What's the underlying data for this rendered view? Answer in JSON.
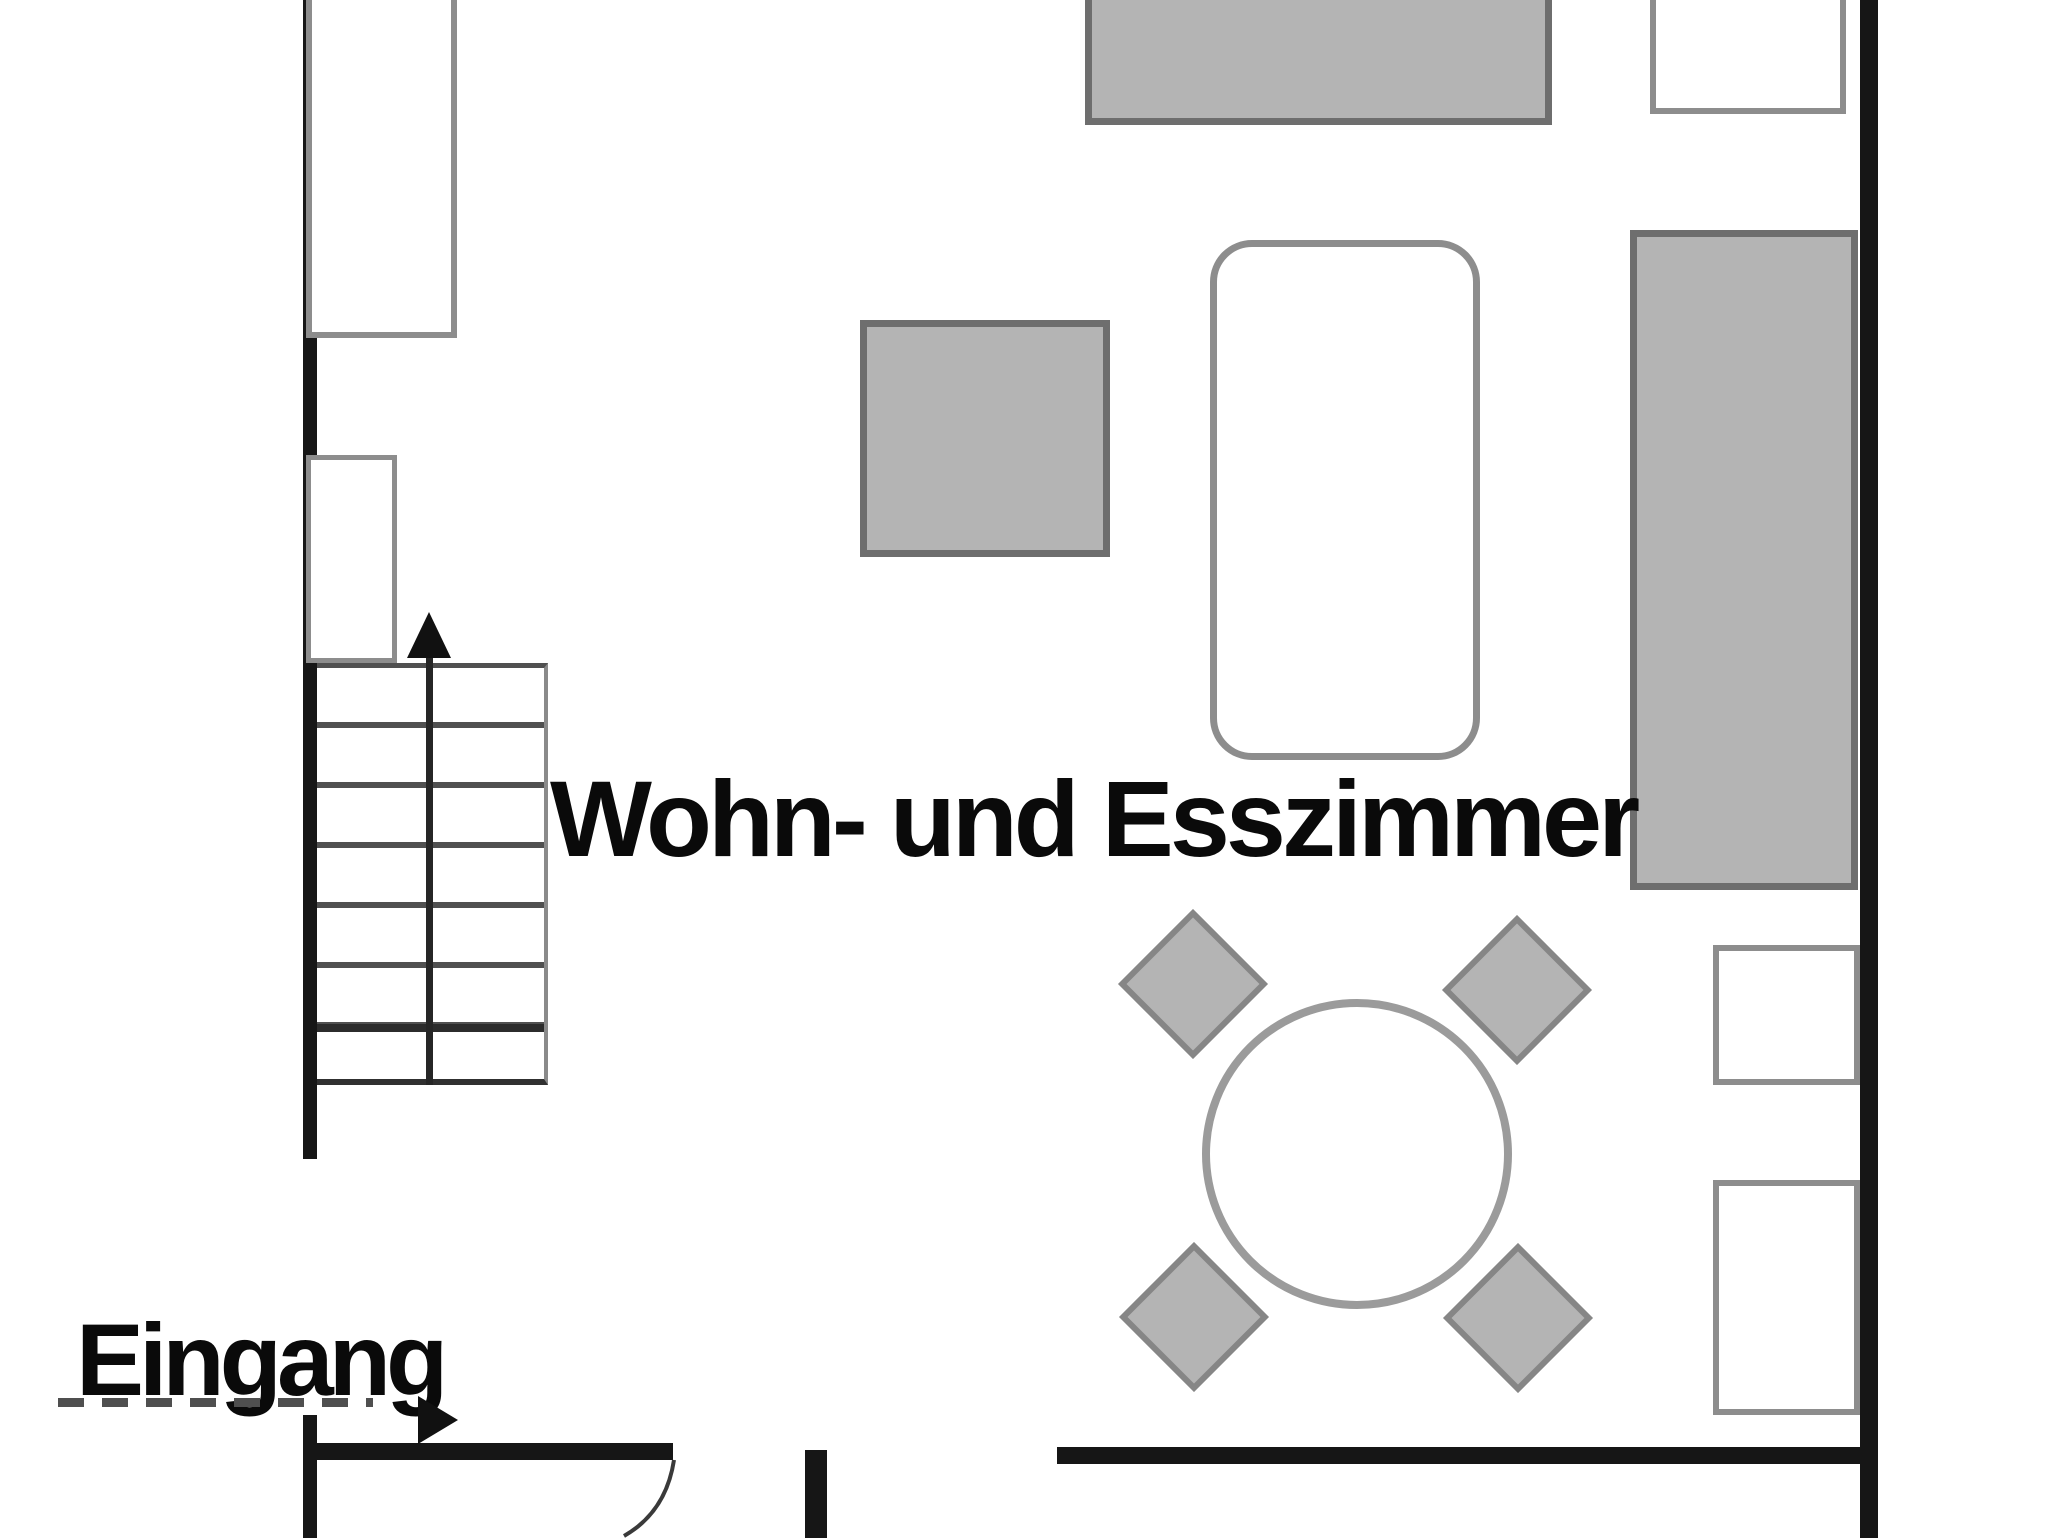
{
  "labels": {
    "room": "Wohn- und Esszimmer",
    "entrance": "Eingang"
  },
  "stairs": {
    "direction_arrow": "up",
    "tread_count": 7
  },
  "entrance": {
    "path_style": "dashed",
    "direction_arrow": "right"
  },
  "colors": {
    "wall": "#161616",
    "furn-fill": "#b4b4b4",
    "furn-border": "#6e6e6e",
    "outline-border": "#8d8d8d",
    "line": "#3c3c3c",
    "text": "#0a0a0a",
    "bg": "#ffffff"
  }
}
